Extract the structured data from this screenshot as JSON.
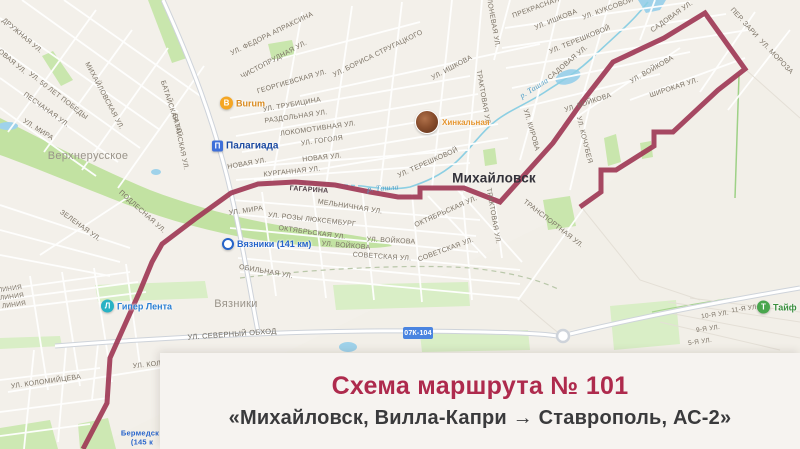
{
  "overlay": {
    "title": "Схема маршрута № 101",
    "subtitle": "«Михайловск, Вилла-Капри → Ставрополь, АС-2»",
    "title_color": "#ae2a4d"
  },
  "map": {
    "road_badge": {
      "text": "07К-104"
    },
    "route": {
      "number": "101",
      "color": "#a03a56",
      "points": "83,449 107,403 110,358 140,291 152,262 162,244 195,219 231,193 258,184 295,182 335,185 370,192 398,197 420,197 420,188 464,188 500,202 553,143 582,102 613,62 664,38 705,13 745,69 718,90 673,132 654,132 654,146 616,170 601,170 601,192 580,207"
    },
    "labels": [
      {
        "t": "Дружная ул.",
        "x": 22,
        "y": 36,
        "r": 40
      },
      {
        "t": "овая ул.",
        "x": 12,
        "y": 62,
        "r": 40
      },
      {
        "t": "Михайловская ул.",
        "x": 104,
        "y": 96,
        "r": 62
      },
      {
        "t": "ул. 50 лет Победы",
        "x": 58,
        "y": 96,
        "r": 38
      },
      {
        "t": "Песчаная ул.",
        "x": 46,
        "y": 110,
        "r": 36
      },
      {
        "t": "ул. Мира",
        "x": 38,
        "y": 130,
        "r": 32
      },
      {
        "t": "Верхнерусское",
        "x": 88,
        "y": 156,
        "r": 0,
        "c": "town"
      },
      {
        "t": "Зеленая ул.",
        "x": 80,
        "y": 226,
        "r": 36
      },
      {
        "t": "Подлесная ул.",
        "x": 142,
        "y": 212,
        "r": 42
      },
      {
        "t": "Батайская ул.",
        "x": 180,
        "y": 142,
        "r": 78
      },
      {
        "t": "Батайская ул.",
        "x": 171,
        "y": 108,
        "r": 72
      },
      {
        "t": "ул. Федора Апраксина",
        "x": 272,
        "y": 34,
        "r": -26
      },
      {
        "t": "Чистопрудная ул.",
        "x": 274,
        "y": 60,
        "r": -28
      },
      {
        "t": "Георгиевская ул.",
        "x": 292,
        "y": 82,
        "r": -16
      },
      {
        "t": "ул. Трубицина",
        "x": 292,
        "y": 105,
        "r": -10
      },
      {
        "t": "Раздольная ул.",
        "x": 296,
        "y": 117,
        "r": -8
      },
      {
        "t": "Локомотивная ул.",
        "x": 318,
        "y": 129,
        "r": -8
      },
      {
        "t": "ул. Гоголя",
        "x": 322,
        "y": 141,
        "r": -8
      },
      {
        "t": "ул. Бориса Стругацкого",
        "x": 378,
        "y": 54,
        "r": -26
      },
      {
        "t": "ул. Ишкова",
        "x": 452,
        "y": 68,
        "r": -28
      },
      {
        "t": "ул. Ишкова",
        "x": 556,
        "y": 20,
        "r": -22
      },
      {
        "t": "Яблоневая ул.",
        "x": 492,
        "y": 18,
        "r": 80
      },
      {
        "t": "Трактовая ул.",
        "x": 483,
        "y": 98,
        "r": 80
      },
      {
        "t": "Прекрасная",
        "x": 536,
        "y": 8,
        "r": -20
      },
      {
        "t": "ул. Куксовой",
        "x": 608,
        "y": 9,
        "r": -20
      },
      {
        "t": "Садовая ул.",
        "x": 672,
        "y": 17,
        "r": -35
      },
      {
        "t": "пер. Зари",
        "x": 744,
        "y": 23,
        "r": 48
      },
      {
        "t": "ул. Мороза",
        "x": 776,
        "y": 57,
        "r": 46
      },
      {
        "t": "ул. Терешковой",
        "x": 580,
        "y": 40,
        "r": -22
      },
      {
        "t": "ул. Терешковой",
        "x": 428,
        "y": 163,
        "r": -24
      },
      {
        "t": "Садовая ул.",
        "x": 568,
        "y": 63,
        "r": -40
      },
      {
        "t": "ул. Войкова",
        "x": 652,
        "y": 70,
        "r": -30
      },
      {
        "t": "Широкая ул.",
        "x": 674,
        "y": 88,
        "r": -18
      },
      {
        "t": "ул. Войкова",
        "x": 588,
        "y": 103,
        "r": -18
      },
      {
        "t": "р. Ташла",
        "x": 534,
        "y": 88,
        "r": -32,
        "c": "water"
      },
      {
        "t": "ул. Кирова",
        "x": 531,
        "y": 130,
        "r": 74
      },
      {
        "t": "ул. Кочубея",
        "x": 584,
        "y": 140,
        "r": 76
      },
      {
        "t": "Михайловск",
        "x": 494,
        "y": 178,
        "r": 0,
        "c": "city"
      },
      {
        "t": "р. Ташла",
        "x": 383,
        "y": 188,
        "r": -4,
        "c": "water"
      },
      {
        "t": "Гагарина",
        "x": 309,
        "y": 190,
        "r": 4,
        "c": "onroute"
      },
      {
        "t": "Новая ул.",
        "x": 247,
        "y": 164,
        "r": -10
      },
      {
        "t": "Новая ул.",
        "x": 322,
        "y": 158,
        "r": -6
      },
      {
        "t": "Курганная ул.",
        "x": 292,
        "y": 172,
        "r": -6
      },
      {
        "t": "Мельничная ул.",
        "x": 350,
        "y": 207,
        "r": 9
      },
      {
        "t": "ул. Розы Люксембург",
        "x": 312,
        "y": 220,
        "r": 6
      },
      {
        "t": "Октябрьская ул.",
        "x": 312,
        "y": 233,
        "r": 8
      },
      {
        "t": "Октябрьская ул.",
        "x": 446,
        "y": 212,
        "r": -24
      },
      {
        "t": "ул. Войкова",
        "x": 346,
        "y": 246,
        "r": 5
      },
      {
        "t": "ул. Войкова",
        "x": 391,
        "y": 241,
        "r": 3
      },
      {
        "t": "Советская ул.",
        "x": 382,
        "y": 257,
        "r": 4
      },
      {
        "t": "Советская ул.",
        "x": 446,
        "y": 250,
        "r": -20
      },
      {
        "t": "Обильная ул.",
        "x": 266,
        "y": 272,
        "r": 10
      },
      {
        "t": "ул. Мира",
        "x": 246,
        "y": 211,
        "r": -8
      },
      {
        "t": "Вязники",
        "x": 236,
        "y": 304,
        "r": 0,
        "c": "town"
      },
      {
        "t": "ул. Северный Обход",
        "x": 232,
        "y": 334,
        "r": -4,
        "c": "st2"
      },
      {
        "t": "линия",
        "x": 10,
        "y": 289,
        "r": -8,
        "c": "sm"
      },
      {
        "t": "линия",
        "x": 12,
        "y": 297,
        "r": -8,
        "c": "sm"
      },
      {
        "t": "линия",
        "x": 14,
        "y": 305,
        "r": -8,
        "c": "sm"
      },
      {
        "t": "ул. Коломийцева",
        "x": 46,
        "y": 382,
        "r": -8
      },
      {
        "t": "ул. Коломийцева",
        "x": 168,
        "y": 363,
        "r": -6
      },
      {
        "t": "Транспортная ул.",
        "x": 553,
        "y": 224,
        "r": 38
      },
      {
        "t": "Трактовая ул.",
        "x": 493,
        "y": 216,
        "r": 80
      },
      {
        "t": "11-я ул.",
        "x": 745,
        "y": 309,
        "r": -8,
        "c": "sm"
      },
      {
        "t": "10-я ул.",
        "x": 715,
        "y": 315,
        "r": -8,
        "c": "sm"
      },
      {
        "t": "9-я ул.",
        "x": 708,
        "y": 329,
        "r": -8,
        "c": "sm"
      },
      {
        "t": "5-я ул.",
        "x": 700,
        "y": 342,
        "r": -8,
        "c": "sm"
      },
      {
        "t": "Бермедск",
        "x": 140,
        "y": 433,
        "r": 0,
        "c": "poi-blue"
      },
      {
        "t": "(145 к",
        "x": 142,
        "y": 442,
        "r": 0,
        "c": "poi-blue"
      }
    ],
    "pois": [
      {
        "name": "Burum",
        "x": 227,
        "y": 103,
        "type": "dot",
        "bg": "#f5a623",
        "glyph": "B",
        "color": "#d98a1f",
        "fs": 9
      },
      {
        "name": "Палагиада",
        "x": 219,
        "y": 146,
        "type": "sq",
        "bg": "#3e6fd9",
        "glyph": "П",
        "color": "#1b49a0",
        "fs": 10
      },
      {
        "name": "Хинкальная",
        "x": 422,
        "y": 122,
        "type": "photo",
        "bg": "",
        "glyph": "",
        "color": "#e5952f",
        "fs": 8
      },
      {
        "name": "Вязники (141 км)",
        "x": 229,
        "y": 244,
        "type": "ring",
        "bg": "",
        "glyph": "",
        "color": "#2563c9",
        "fs": 9
      },
      {
        "name": "Гипер Лента",
        "x": 108,
        "y": 306,
        "type": "dot",
        "bg": "#27b2c4",
        "glyph": "Л",
        "color": "#2a7fd4",
        "fs": 9
      },
      {
        "name": "Тайф",
        "x": 764,
        "y": 307,
        "type": "dot",
        "bg": "#49a64d",
        "glyph": "Т",
        "color": "#3b8f3e",
        "fs": 9
      }
    ]
  }
}
